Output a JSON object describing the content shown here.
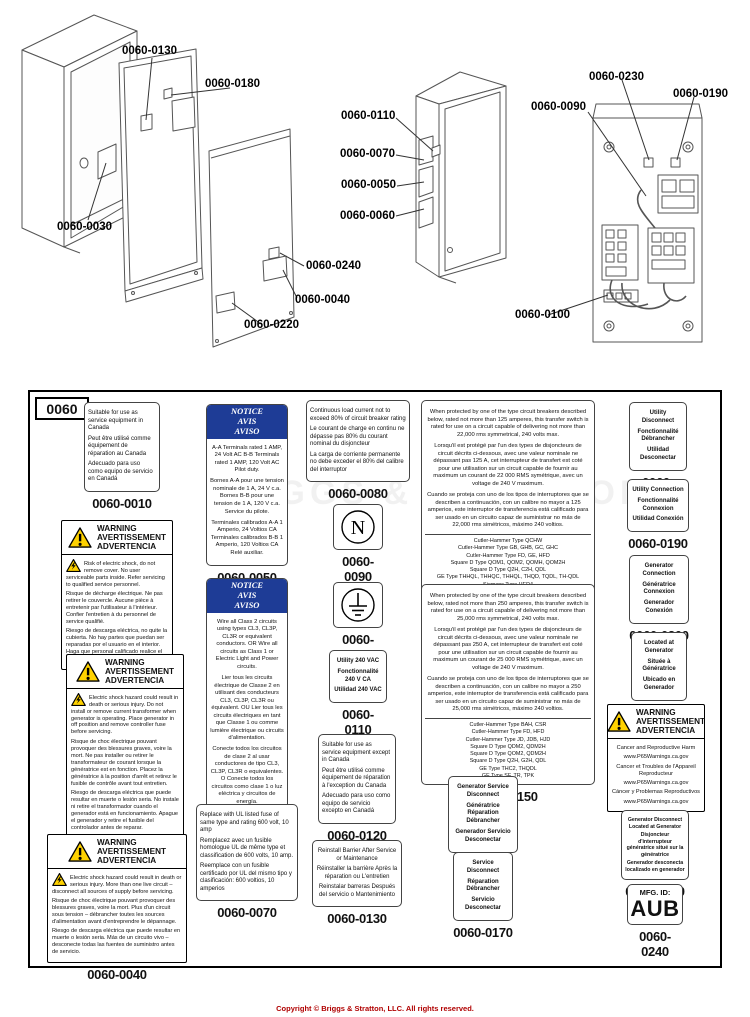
{
  "page": {
    "footer_copyright": "Copyright © Briggs & Stratton, LLC. All rights reserved.",
    "watermark": "BRIGGS & STRATTON"
  },
  "diagram": {
    "sheet_id": "0060",
    "callouts": {
      "c0030": "0060-0030",
      "c0040": "0060-0040",
      "c0050": "0060-0050",
      "c0060": "0060-0060",
      "c0070": "0060-0070",
      "c0090": "0060-0090",
      "c0100": "0060-0100",
      "c0110": "0060-0110",
      "c0130": "0060-0130",
      "c0180": "0060-0180",
      "c0190": "0060-0190",
      "c0220": "0060-0220",
      "c0230": "0060-0230",
      "c0240": "0060-0240"
    }
  },
  "labels": {
    "l0010": {
      "caption": "0060-0010",
      "lines": [
        "Suitable for use as service equipment in Canada",
        "Peut être utilisé comme équipement de réparation au Canada",
        "Adecuado para uso como equipo de servicio en Canadá"
      ]
    },
    "l0020": {
      "caption": "0060-0020",
      "title": [
        "WARNING",
        "AVERTISSEMENT",
        "ADVERTENCIA"
      ],
      "lines": [
        "Risk of electric shock, do not remove cover. No user serviceable parts inside. Refer servicing to qualified service personnel.",
        "Risque de décharge électrique. Ne pas retirer le couvercle. Aucune pièce à entretenir par l'utilisateur à l'intérieur. Confier l'entretien à du personnel de service qualifié.",
        "Riesgo de descarga eléctrica, no quite la cubierta. No hay partes que puedan ser reparadas por el usuario en el interior. Haga que personal calificado realice el servicio."
      ]
    },
    "l0030": {
      "caption": "0060-0030",
      "title": [
        "WARNING",
        "AVERTISSEMENT",
        "ADVERTENCIA"
      ],
      "lines": [
        "Electric shock hazard could result in death or serious injury. Do not install or remove current transformer when generator is operating. Place generator in off position and remove controller fuse before servicing.",
        "Risque de choc électrique pouvant provoquer des blessures graves, voire la mort. Ne pas installer ou retirer le transformateur de courant lorsque la génératrice est en fonction. Placez la génératrice à la position d'arrêt et retirez le fusible de contrôle avant tout entretien.",
        "Riesgo de descarga eléctrica que puede resultar en muerte o lesión seria. No instale ni retire el transformador cuando el generador está en funcionamiento. Apague el generador y retire el fusible del controlador antes de reparar."
      ]
    },
    "l0040": {
      "caption": "0060-0040",
      "title": [
        "WARNING",
        "AVERTISSEMENT",
        "ADVERTENCIA"
      ],
      "lines": [
        "Electric shock hazard could result in death or serious injury. More than one live circuit – disconnect all sources of supply before servicing.",
        "Risque de choc électrique pouvant provoquer des blessures graves, voire la mort. Plus d'un circuit sous tension – débrancher toutes les sources d'alimentation avant d'entreprendre le dépannage.",
        "Riesgo de descarga eléctrica que puede resultar en muerte o lesión seria. Más de un circuito vivo – desconecte todas las fuentes de suministro antes de servicio."
      ]
    },
    "l0050": {
      "caption": "0060-0050",
      "title": [
        "NOTICE",
        "AVIS",
        "AVISO"
      ],
      "lines": [
        "A-A Terminals rated 1 AMP, 24 Volt AC B-B Terminals rated 1 AMP, 120 Volt AC Pilot duty.",
        "Bornes A-A pour une tension nominale de 1 A, 24 V c.a. Bornes B-B pour une tension de 1 A, 120 V c.a. Service du pilote.",
        "Terminales calibrados A-A 1 Amperio, 24 Voltios CA Terminales calibrados B-B 1 Amperio, 120 Voltios CA Relé auxiliar."
      ]
    },
    "l0060": {
      "caption": "0060-0060",
      "title": [
        "NOTICE",
        "AVIS",
        "AVISO"
      ],
      "lines": [
        "Wire all Class 2 circuits using types CL3, CL3P, CL3R or equivalent conductors. OR Wire all circuits as Class 1 or Electric Light and Power circuits.",
        "Lier tous les circuits électrique de Classe 2 en utilisant des conducteurs CL3, CL3P, CL3R ou équivalent. OU Lier tous les circuits électriques en tant que Classe 1 ou comme lumière électrique ou circuits d'alimentation.",
        "Conecte todos los circuitos de clase 2 al usar conductores de tipo CL3, CL3P, CL3R o equivalentes. O Conecte todos los circuitos como clase 1 o luz eléctrica y circuitos de energía."
      ]
    },
    "l0070": {
      "caption": "0060-0070",
      "lines": [
        "Replace with UL listed fuse of same type and rating 600 volt, 10 amp",
        "Remplacez avec un fusible homologue UL de même type et classification de 600 volts, 10 amp.",
        "Reemplace con un fusible certificado por UL del mismo tipo y clasificación: 600 voltios, 10 amperios"
      ]
    },
    "l0080": {
      "caption": "0060-0080",
      "lines": [
        "Continuous load current not to exceed 80% of circuit breaker rating",
        "Le courant de charge en continu ne dépasse pas 80% du courant nominal du disjoncteur",
        "La carga de corriente permanente no debe exceder el 80% del calibre del interruptor"
      ]
    },
    "l0090": {
      "caption": "0060-0090",
      "symbol": "N"
    },
    "l0100": {
      "caption": "0060-0100",
      "symbol": "ground"
    },
    "l0110": {
      "caption": "0060-0110",
      "lines": [
        "Utility 240 VAC",
        "Fonctionnalité 240 V CA",
        "Utilidad 240 VAC"
      ]
    },
    "l0120": {
      "caption": "0060-0120",
      "lines": [
        "Suitable for use as service equipment except in Canada",
        "Peut être utilisé comme équipement de réparation à l'exception du Canada",
        "Adecuado para uso como equipo de servicio excepto en Canadá"
      ]
    },
    "l0130": {
      "caption": "0060-0130",
      "lines": [
        "Reinstall Barrier After Service or Maintenance",
        "Réinstaller la barrière Après la réparation ou L'entretien",
        "Reinstalar barreras Después del servicio o Mantenimiento"
      ]
    },
    "l0140": {
      "caption": "0060-0140",
      "lines": [
        "When protected by one of the type circuit breakers described below, rated not more than 125 amperes, this transfer switch is rated for use on a circuit capable of delivering not more than 22,000 rms symmetrical, 240 volts max.",
        "Lorsqu'il est protégé par l'un des types de disjoncteurs de circuit décrits ci-dessous, avec une valeur nominale ne dépassant pas 125 A, cet interrupteur de transfert est coté pour une utilisation sur un circuit capable de fournir au maximum un courant de 22 000 RMS symétrique, avec un voltage de 240 V maximum.",
        "Cuando se proteja con uno de los tipos de interruptores que se describen a continuación, con un calibre no mayor a 125 amperios, este interruptor de transferencia está calificado para ser usado en un circuito capaz de suministrar no más de 22,000 rms simétricos, máximo 240 voltios."
      ],
      "breakers": [
        "Cutler-Hammer Type QCHW",
        "Cutler-Hammer Type GB, GHB, GC, GHC",
        "Cutler-Hammer Type FD, GE, HFD",
        "Square D Type QOM1, QOM2, QOMH, QOM2H",
        "Square D Type Q2H, C2H, QDL",
        "GE Type THHQL, THHQC, THHQL, THQD, TQDL, TH-QDL",
        "Siemens Type HED4"
      ]
    },
    "l0150": {
      "caption": "0060-0150",
      "lines": [
        "When protected by one of the type circuit breakers described below, rated not more than 250 amperes, this transfer switch is rated for use on a circuit capable of delivering not more than 25,000 rms symmetrical, 240 volts max.",
        "Lorsqu'il est protégé par l'un des types de disjoncteurs de circuit décrits ci-dessous, avec une valeur nominale ne dépassant pas 250 A, cet interrupteur de transfert est coté pour une utilisation sur un circuit capable de fournir au maximum un courant de 25 000 RMS symétrique, avec un voltage de 240 V maximum.",
        "Cuando se proteja con uno de los tipos de interruptores que se describen a continuación, con un calibre no mayor a 250 amperios, este interruptor de transferencia está calificado para ser usado en un circuito capaz de suministrar no más de 25,000 rms simétricos, máximo 240 voltios."
      ],
      "breakers": [
        "Cutler-Hammer Type BAH, CSR",
        "Cutler-Hammer Type FD, HFD",
        "Cutler-Hammer Type JD, JDB, HJD",
        "Square D Type QDM2, QDM2H",
        "Square D Type QOM2, QDM2H",
        "Square D Type Q2H, G2H, QDL",
        "GE Type THC2, THQDL",
        "GE Type SF, TR, TPK"
      ]
    },
    "l0160": {
      "caption": "0060-0160",
      "lines": [
        "Generator Service Disconnect",
        "Génératrice Réparation Débrancher",
        "Generador Servicio Desconectar"
      ]
    },
    "l0170": {
      "caption": "0060-0170",
      "lines": [
        "Service Disconnect",
        "Réparation Débrancher",
        "Servicio Desconectar"
      ]
    },
    "l0180": {
      "caption": "0060-0180",
      "lines": [
        "Utility Disconnect",
        "Fonctionnalité Débrancher",
        "Utilidad Desconectar"
      ]
    },
    "l0190": {
      "caption": "0060-0190",
      "lines": [
        "Utility Connection",
        "Fonctionnalité Connexion",
        "Utilidad Conexión"
      ]
    },
    "l0200": {
      "caption": "0060-0200",
      "lines": [
        "Generator Connection",
        "Génératrice Connexion",
        "Generador Conexión"
      ]
    },
    "l0210": {
      "caption": "0060-0210",
      "lines": [
        "Located at Generator",
        "Située à Génératrice",
        "Ubicado en Generador"
      ]
    },
    "l0220": {
      "caption": "0060-0220",
      "title": [
        "WARNING",
        "AVERTISSEMENT",
        "ADVERTENCIA"
      ],
      "lines": [
        "Cancer and Reproductive Harm",
        "www.P65Warnings.ca.gov",
        "Cancer et Troubles de l'Appareil Reproducteur",
        "www.P65Warnings.ca.gov",
        "Cáncer y Problemas Reproductivos",
        "www.P65Warnings.ca.gov"
      ]
    },
    "l0230": {
      "caption": "0060-0230",
      "lines": [
        "Generator Disconnect Located at Generator",
        "Disjoncteur d'interrupteur génératrice situé sur la génératrice",
        "Generador desconecta localizado en generador"
      ]
    },
    "l0240": {
      "caption": "0060-0240",
      "title_text": "MFG. ID:",
      "id_text": "AUB"
    }
  }
}
